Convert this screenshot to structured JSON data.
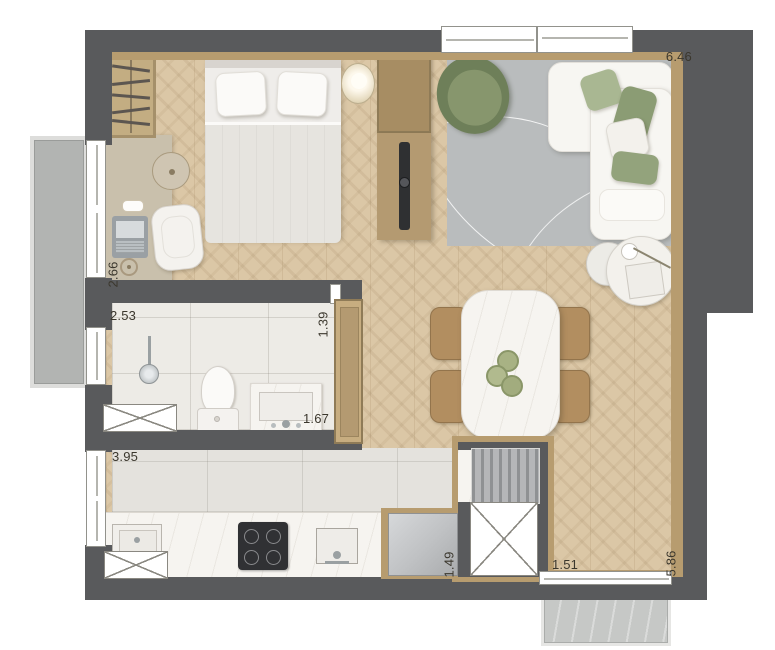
{
  "floorplan": {
    "dimension_labels": [
      {
        "value": "6.46",
        "area": "living-room-width",
        "orientation": "horizontal"
      },
      {
        "value": "2.66",
        "area": "bedroom-depth",
        "orientation": "vertical"
      },
      {
        "value": "2.53",
        "area": "bathroom-width",
        "orientation": "horizontal"
      },
      {
        "value": "1.39",
        "area": "bathroom-depth",
        "orientation": "vertical"
      },
      {
        "value": "1.67",
        "area": "vanity-width",
        "orientation": "horizontal"
      },
      {
        "value": "3.95",
        "area": "kitchen-width",
        "orientation": "horizontal"
      },
      {
        "value": "1.49",
        "area": "fridge-niche",
        "orientation": "vertical"
      },
      {
        "value": "1.51",
        "area": "hall-width",
        "orientation": "horizontal"
      },
      {
        "value": "5.86",
        "area": "living-room-depth",
        "orientation": "vertical"
      }
    ],
    "features": [
      "bedroom",
      "living-room",
      "bathroom",
      "kitchen",
      "dining-area",
      "balcony",
      "service-shaft"
    ],
    "colors": {
      "wall": "#595a5c",
      "wood_floor": "#dbc7a6",
      "wood_trim": "#b79c6f",
      "rug": "#b9bcbd",
      "armchair_green": "#76875f",
      "pillow_green": "#9aa983",
      "bath_tile": "#edebe6",
      "kitchen_tile": "#e4e2dd",
      "counter_marble": "#f6f4f0",
      "balcony_slab": "#b2b4b2",
      "cooktop": "#303134",
      "fridge": "#c6c8ca",
      "dining_chair": "#b28e60",
      "label_text": "#3b372d"
    }
  }
}
